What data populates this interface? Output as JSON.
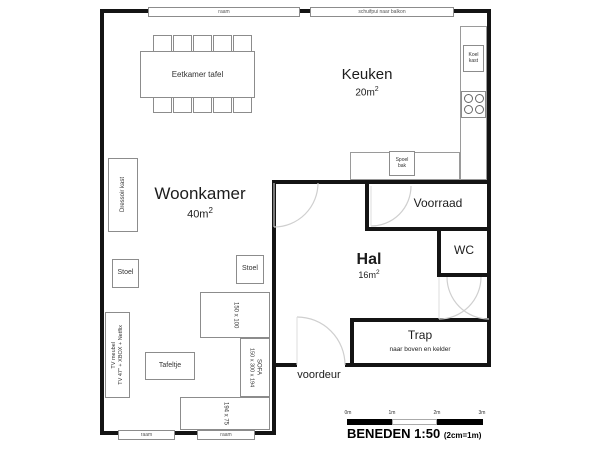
{
  "rooms": {
    "woonkamer": {
      "name": "Woonkamer",
      "area_value": "40m",
      "area_sup": "2"
    },
    "keuken": {
      "name": "Keuken",
      "area_value": "20m",
      "area_sup": "2"
    },
    "hal": {
      "name": "Hal",
      "area_value": "16m",
      "area_sup": "2"
    },
    "voorraad": {
      "name": "Voorraad"
    },
    "wc": {
      "name": "WC"
    },
    "trap": {
      "name": "Trap",
      "subtitle": "naar boven en kelder"
    },
    "voordeur": {
      "name": "voordeur"
    }
  },
  "windows": {
    "top_left": "raam",
    "top_right": "schuifpui naar balkon",
    "bottom_left": "raam",
    "bottom_right": "raam"
  },
  "furniture": {
    "eetkamer_tafel": "Eetkamer tafel",
    "dressoir": "Dressoir kast",
    "stoel_left": "Stoel",
    "stoel_right": "Stoel",
    "tv_meubel_line1": "TV meubel",
    "tv_meubel_line2": "TV 47\" + XBOX + Netflix",
    "tafeltje": "Tafeltje",
    "sofa_top_dim": "150 x 100",
    "sofa_side_dim": "150 x 300 x 194",
    "sofa_label": "SOFA",
    "sofa_bottom_dim": "194 x 75",
    "koelkast": "Koel kast",
    "spoelbak": "Spoel bak"
  },
  "scale": {
    "title": "BENEDEN 1:50",
    "note": "(2cm=1m)",
    "ticks": [
      "0m",
      "1m",
      "2m",
      "3m"
    ]
  },
  "colors": {
    "wall": "#141414",
    "furniture_border": "#8c8c8c",
    "door_arc": "#cfcfcf"
  }
}
